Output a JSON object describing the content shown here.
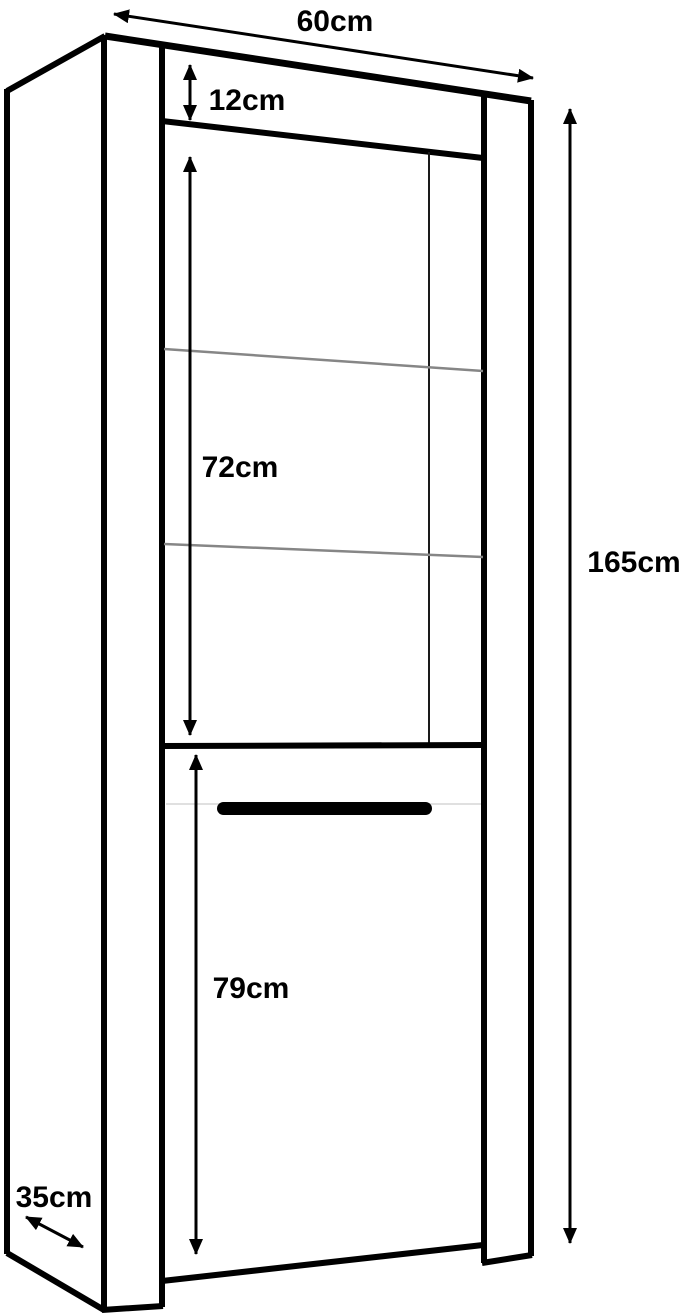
{
  "dimension_labels": {
    "width": "60cm",
    "top_section": "12cm",
    "glass_section": "72cm",
    "door_section": "79cm",
    "total_height": "165cm",
    "depth": "35cm"
  },
  "colors": {
    "background": "#ffffff",
    "line": "#000000",
    "shelf_line": "#868686",
    "groove_line": "#e0e0e0"
  }
}
